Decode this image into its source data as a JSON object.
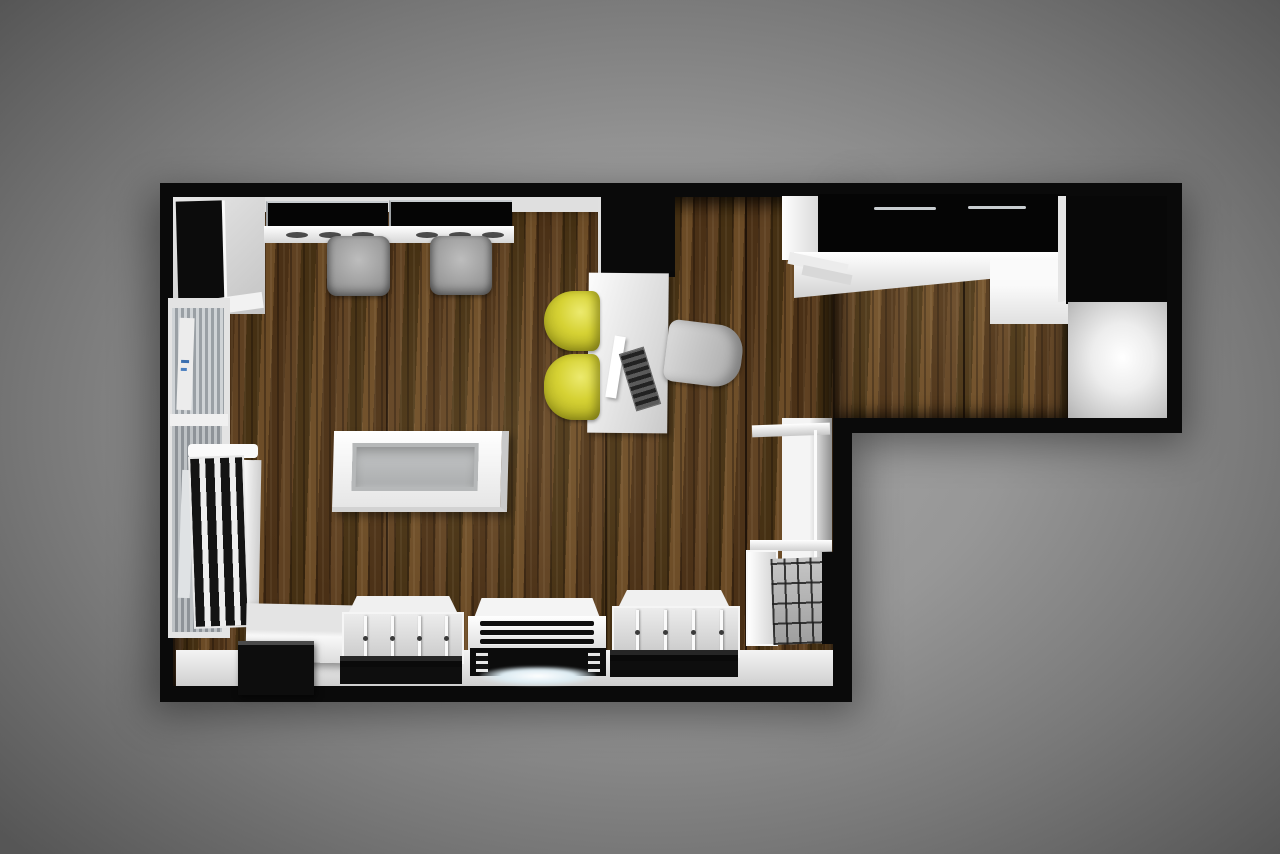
{
  "scene": {
    "type": "3d-top-down-floor-plan-render",
    "subject": "L-shaped retail shop interior with dark walnut flooring, white display furniture and black counters",
    "visible_text": "",
    "lighting": "soft spotlight vignette on gray studio background"
  },
  "palette": {
    "bg-center": "#a6a6a6",
    "bg-edge": "#565656",
    "wall-black": "#0a0a0a",
    "wood-base": "#573a1d",
    "wood-dark": "#3c2712",
    "wood-light": "#6b4b26",
    "white-surface": "#f2f2f2",
    "gray-surface": "#cfcfcf",
    "glass": "#b7bcbf",
    "chair-gray": "#8f8f8f",
    "chair-yellow": "#d6d234",
    "glow-white": "#ffffff"
  },
  "furniture": {
    "corner-cabinet": "black wall cabinet in white top-left corner niche",
    "styling-stations": "two black wall counters with white ledge, knobs and two gray stools",
    "left-display-case": "glazed wall vitrine with posters along left wall",
    "slat-rack": "white rack with vertical black slats on left wall",
    "island-display": "freestanding white display table with recessed glass top",
    "consultation-desk": "white desk with black wall cabinet, monitor and keyboard",
    "yellow-chairs": "two yellow staff chairs",
    "client-chair": "gray client chair",
    "reception-counter": "long black-topped counter with white fascia in right wing",
    "illuminated-panel": "glowing white wall panel in right wing",
    "bench": "white bench with black cube table at bottom-left",
    "tray-units": "two white partitioned product trays on black bases",
    "center-display-case": "white sloped display case with black slats and glowing base",
    "grid-rack": "wire grid shelf unit on lower right wall"
  }
}
